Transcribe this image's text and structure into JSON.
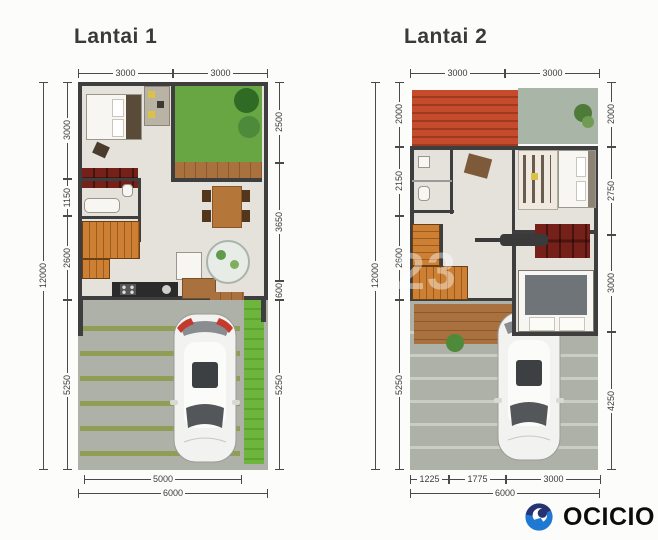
{
  "floor1": {
    "title": "Lantai 1",
    "dims": {
      "top": [
        "3000",
        "3000"
      ],
      "left_total": "12000",
      "left": [
        "3000",
        "1150",
        "2600",
        "5250"
      ],
      "right": [
        "2500",
        "3650",
        "600",
        "5250"
      ],
      "bottom": [
        "5000"
      ],
      "bottom_total": "6000"
    }
  },
  "floor2": {
    "title": "Lantai 2",
    "dims": {
      "top": [
        "3000",
        "3000"
      ],
      "left_total": "12000",
      "left": [
        "2000",
        "2150",
        "2600",
        "5250"
      ],
      "right": [
        "2000",
        "2750",
        "3000",
        "4250"
      ],
      "bottom": [
        "1225",
        "1775",
        "3000"
      ],
      "bottom_total": "6000"
    }
  },
  "watermark": "23",
  "logo": {
    "text": "OCICIO"
  },
  "palette": {
    "wall": "#3e3e3e",
    "floor": "#e4e2db",
    "garden_green": "#67a643",
    "lawn_green": "#6db53c",
    "roof_red": "#c2492c",
    "wood_deck": "#a9713d",
    "stairs_orange": "#cd8034",
    "shelf_red": "#752019",
    "carport_gray": "#aeb1a8",
    "stripe_olive": "#8f9d55",
    "dim_line": "#4a4a4a",
    "logo_navy": "#283271",
    "logo_blue": "#1f78d1"
  }
}
